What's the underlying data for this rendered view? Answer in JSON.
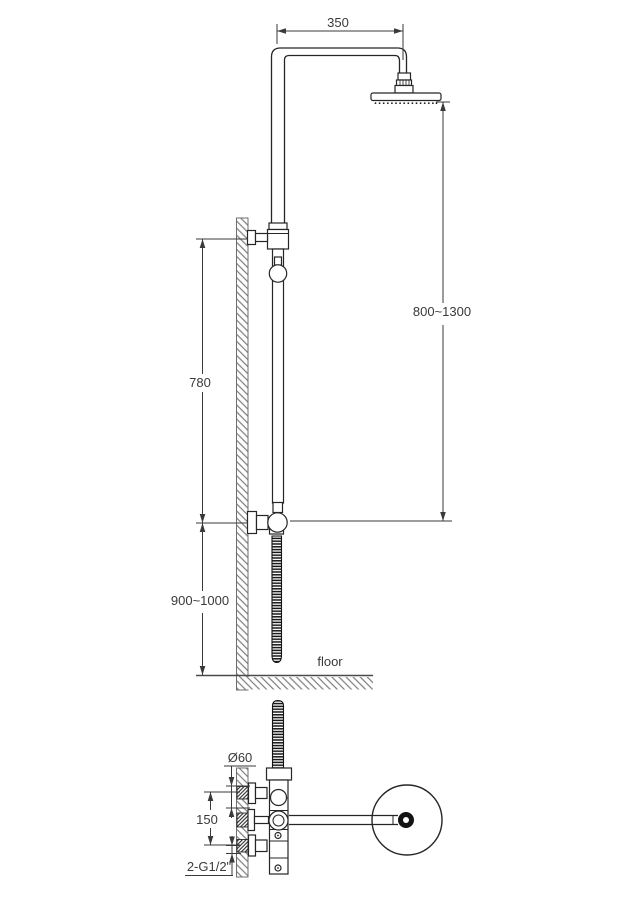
{
  "drawing": {
    "background": "#ffffff",
    "line_color": "#262626",
    "dim_color": "#3a3a3a",
    "hatch_color": "#7d7d7d",
    "side_view": {
      "dim_arm_reach": "350",
      "dim_head_height": "800~1300",
      "dim_slide_bar": "780",
      "dim_valve_height": "900~1000",
      "floor_label": "floor"
    },
    "plan_view": {
      "dim_escutcheon_diameter": "Ø60",
      "dim_inlet_spacing": "150",
      "dim_thread_spec": "2-G1/2\""
    }
  }
}
